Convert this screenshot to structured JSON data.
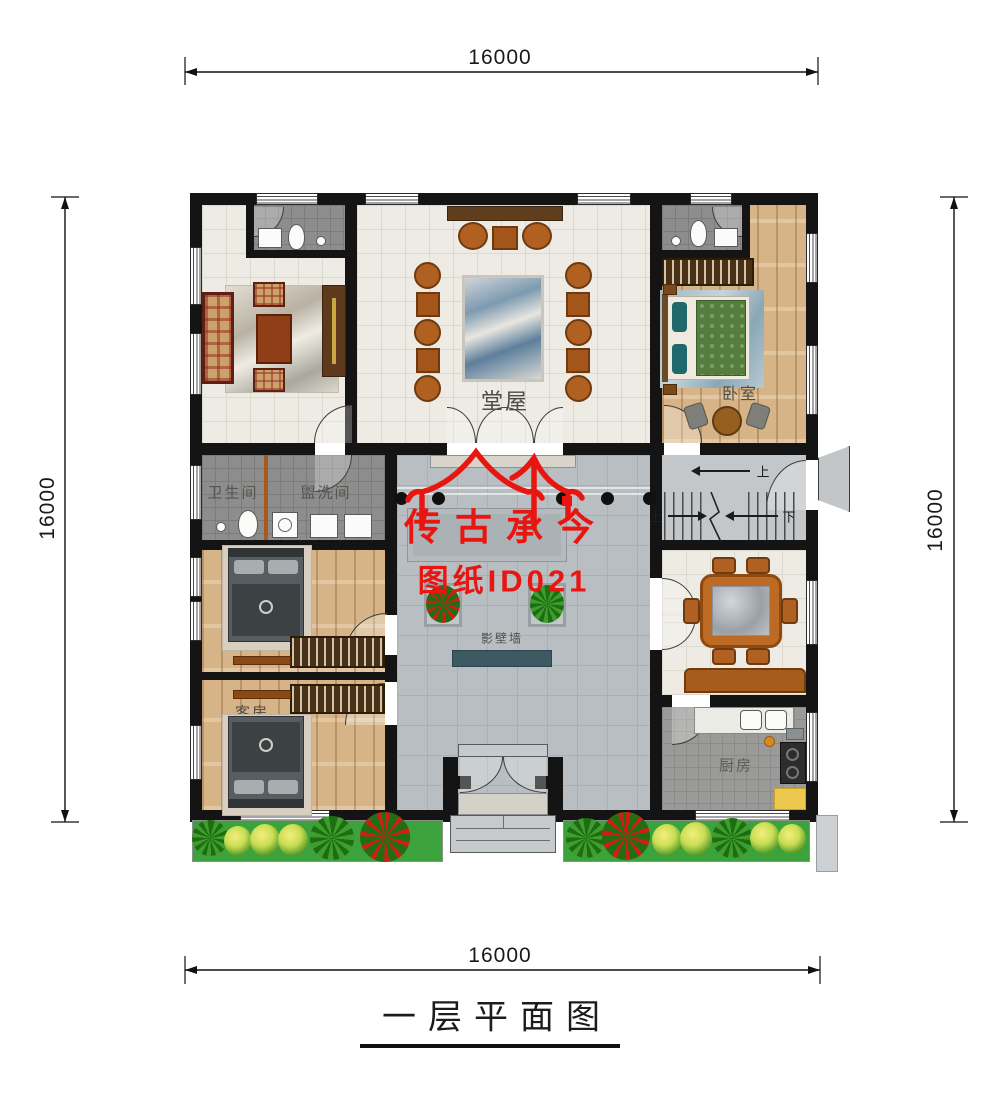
{
  "title": {
    "text": "一层平面图"
  },
  "dimensions": {
    "top": "16000",
    "bottom": "16000",
    "left": "16000",
    "right": "16000"
  },
  "watermark": {
    "brand": "传古承今",
    "sheet_id": "图纸ID021"
  },
  "rooms": {
    "main_hall": "堂屋",
    "bedroom": "卧室",
    "bathroom": "卫生间",
    "washroom": "盥洗间",
    "guest_room": "客房",
    "kitchen": "厨房",
    "screen_wall": "影壁墙"
  },
  "stairs": {
    "up_main": "上",
    "up_flight": "上",
    "down_flight": "下"
  },
  "colors": {
    "watermark_red": "#e81510",
    "screen_wall": "#3d5a63",
    "garden_green": "#3ca23b",
    "wall_black": "#141414"
  }
}
